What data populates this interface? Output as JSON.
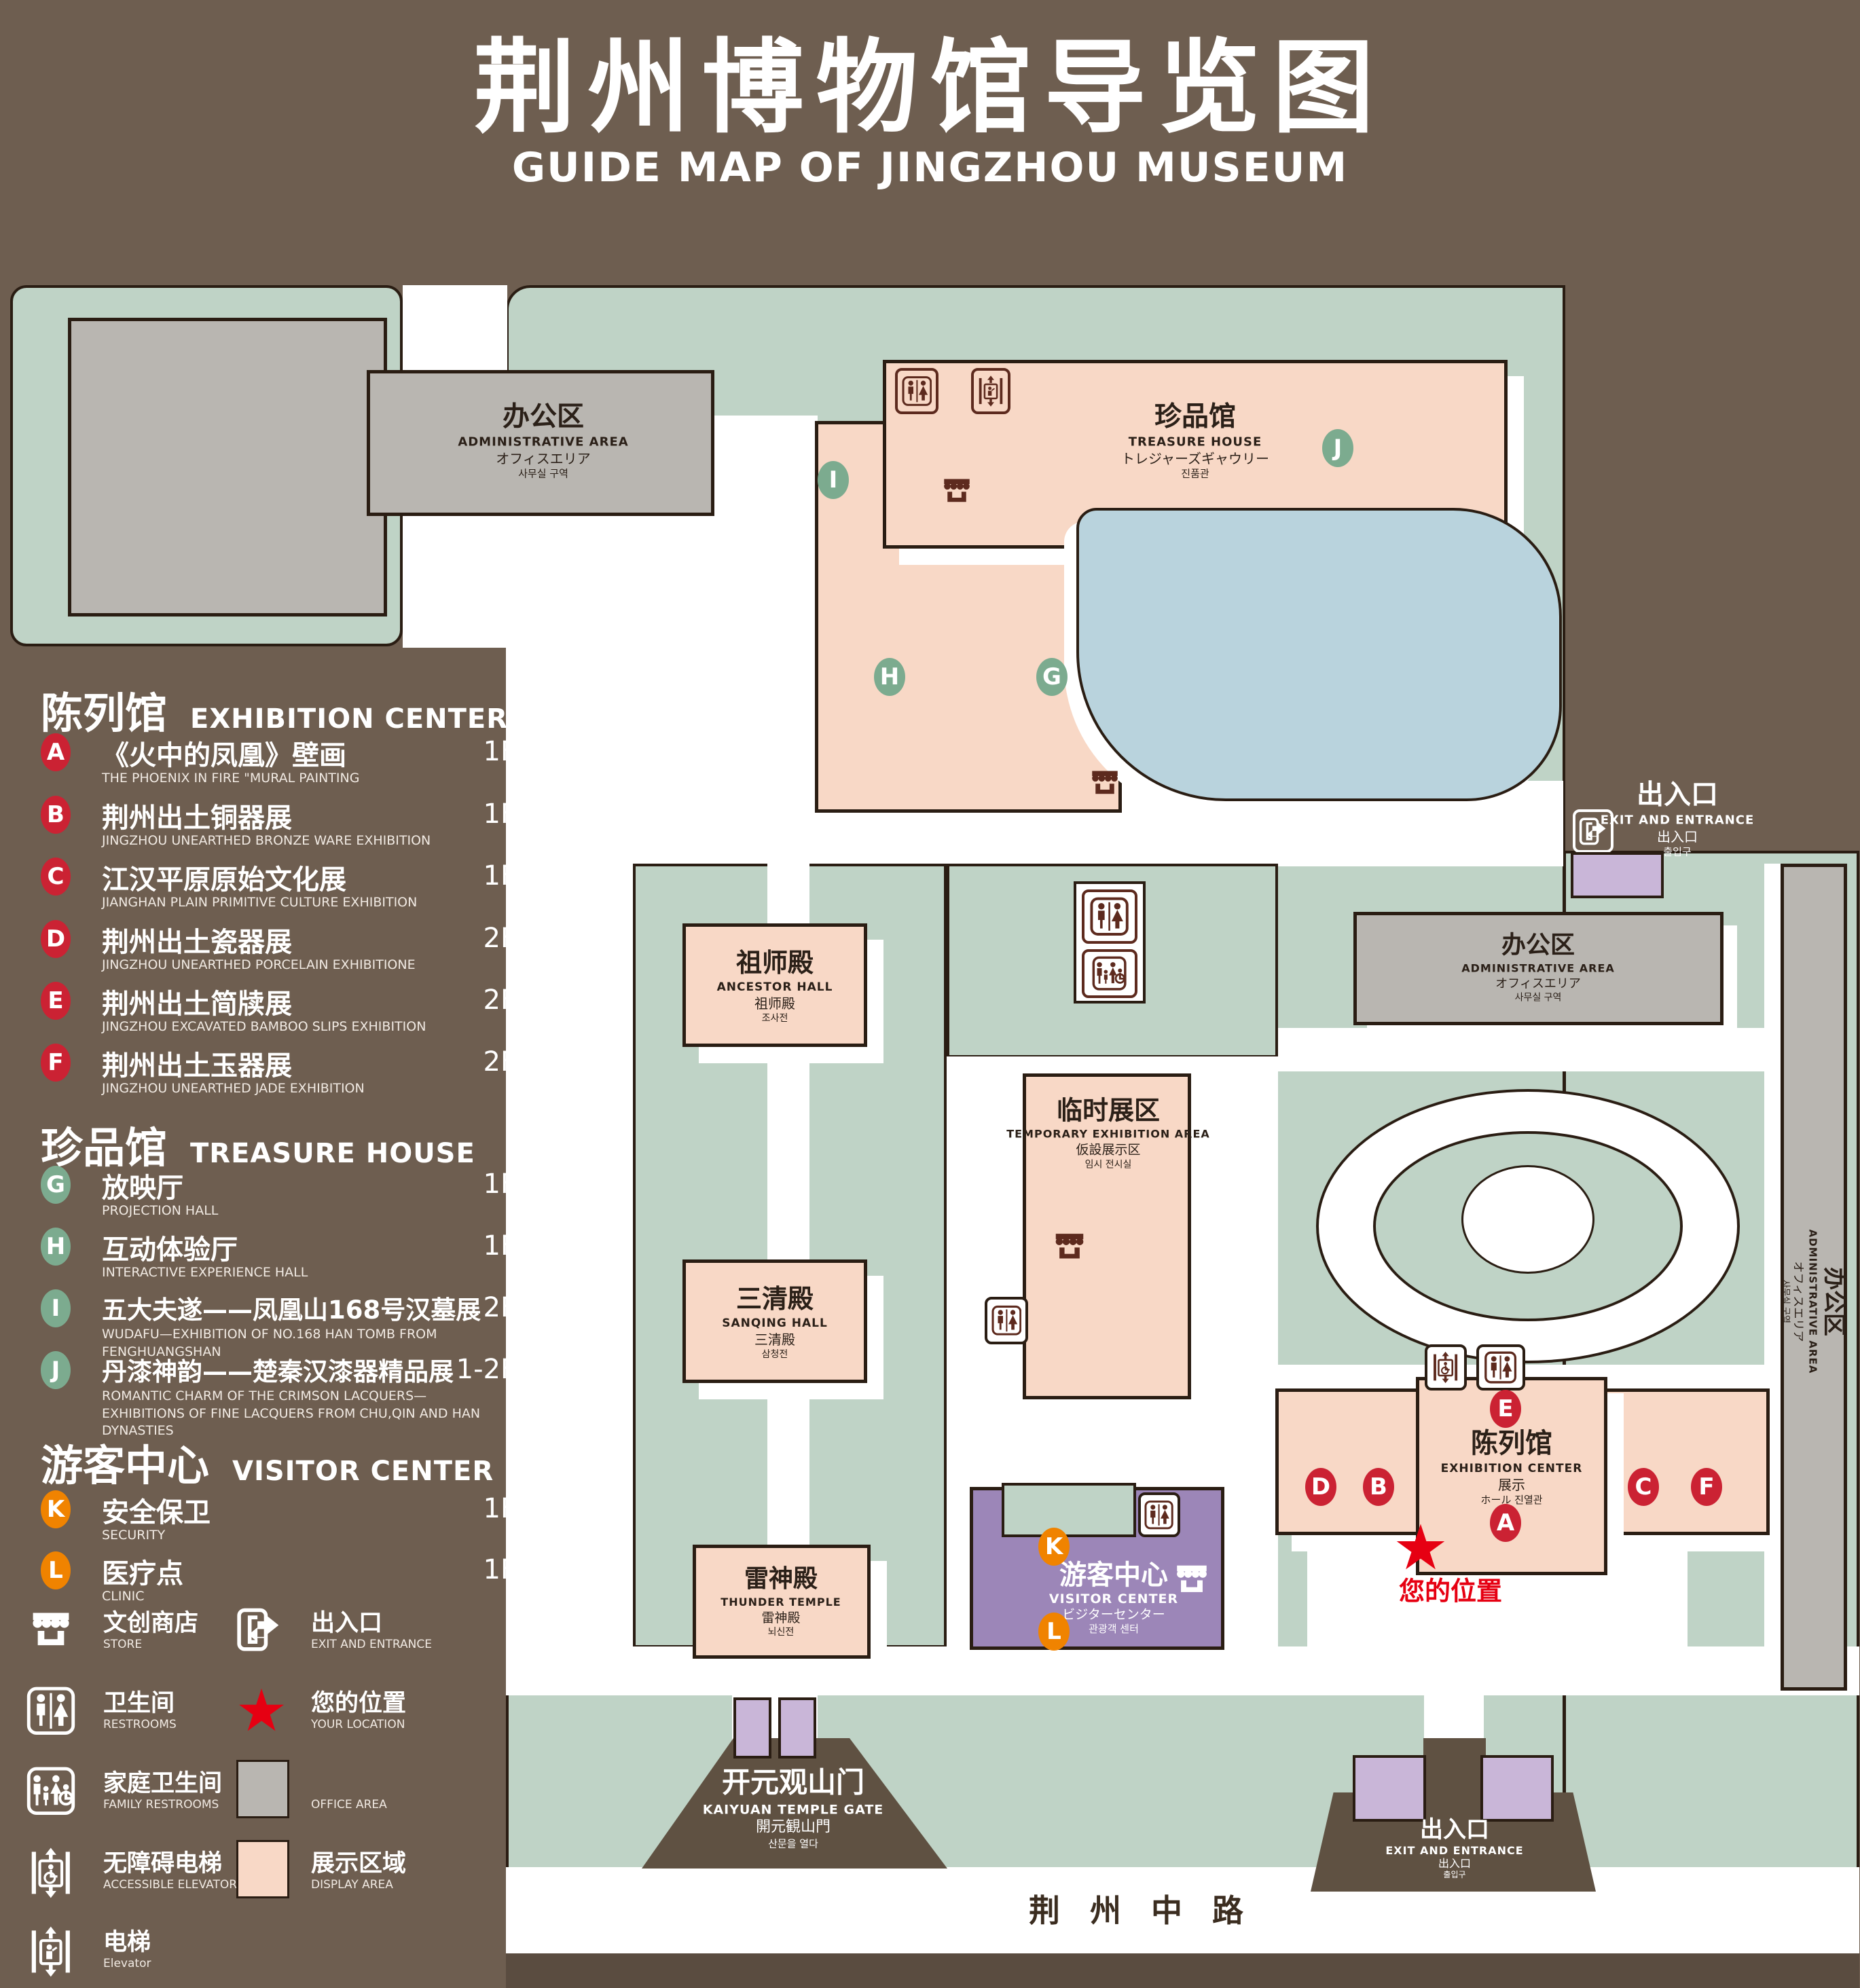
{
  "title": {
    "zh": "荆州博物馆导览图",
    "en": "GUIDE MAP OF JINGZHOU MUSEUM"
  },
  "legend": {
    "sections": [
      {
        "title_zh": "陈列馆",
        "title_en": "EXHIBITION CENTER",
        "items": [
          {
            "letter": "A",
            "zh": "《火中的凤凰》壁画",
            "en": "THE PHOENIX IN FIRE \"MURAL PAINTING",
            "floor": "1F"
          },
          {
            "letter": "B",
            "zh": "荆州出土铜器展",
            "en": "JINGZHOU UNEARTHED BRONZE WARE EXHIBITION",
            "floor": "1F"
          },
          {
            "letter": "C",
            "zh": "江汉平原原始文化展",
            "en": "JIANGHAN PLAIN PRIMITIVE CULTURE EXHIBITION",
            "floor": "1F"
          },
          {
            "letter": "D",
            "zh": "荆州出土瓷器展",
            "en": "JINGZHOU UNEARTHED PORCELAIN EXHIBITIONE",
            "floor": "2F"
          },
          {
            "letter": "E",
            "zh": "荆州出土简牍展",
            "en": "JINGZHOU EXCAVATED BAMBOO SLIPS EXHIBITION",
            "floor": "2F"
          },
          {
            "letter": "F",
            "zh": "荆州出土玉器展",
            "en": "JINGZHOU UNEARTHED JADE EXHIBITION",
            "floor": "2F"
          }
        ]
      },
      {
        "title_zh": "珍品馆",
        "title_en": "TREASURE HOUSE",
        "items": [
          {
            "letter": "G",
            "zh": "放映厅",
            "en": "PROJECTION HALL",
            "floor": "1F"
          },
          {
            "letter": "H",
            "zh": "互动体验厅",
            "en": "INTERACTIVE EXPERIENCE HALL",
            "floor": "1F"
          },
          {
            "letter": "I",
            "zh": "五大夫遂——凤凰山168号汉墓展",
            "en": "WUDAFU—EXHIBITION OF NO.168 HAN TOMB FROM FENGHUANGSHAN",
            "floor": "2F"
          },
          {
            "letter": "J",
            "zh": "丹漆神韵——楚秦汉漆器精品展",
            "en": "ROMANTIC CHARM OF THE CRIMSON LACQUERS—EXHIBITIONS OF FINE LACQUERS FROM CHU,QIN AND HAN DYNASTIES",
            "floor": "1-2F"
          }
        ]
      },
      {
        "title_zh": "游客中心",
        "title_en": "VISITOR CENTER",
        "items": [
          {
            "letter": "K",
            "zh": "安全保卫",
            "en": "SECURITY",
            "floor": "1F"
          },
          {
            "letter": "L",
            "zh": "医疗点",
            "en": "CLINIC",
            "floor": "1F"
          }
        ]
      }
    ],
    "symbols": [
      {
        "icon": "store-icon",
        "zh": "文创商店",
        "en": "STORE"
      },
      {
        "icon": "exit-icon",
        "zh": "出入口",
        "en": "EXIT AND ENTRANCE"
      },
      {
        "icon": "restrooms-icon",
        "zh": "卫生间",
        "en": "RESTROOMS"
      },
      {
        "icon": "your-location-icon",
        "zh": "您的位置",
        "en": "YOUR LOCATION"
      },
      {
        "icon": "family-restrooms-icon",
        "zh": "家庭卫生间",
        "en": "FAMILY RESTROOMS"
      },
      {
        "icon": "office-area-swatch",
        "zh": "办公区域",
        "en": "OFFICE AREA"
      },
      {
        "icon": "accessible-elevator-icon",
        "zh": "无障碍电梯",
        "en": "ACCESSIBLE ELEVATOR"
      },
      {
        "icon": "display-area-swatch",
        "zh": "展示区域",
        "en": "DISPLAY AREA"
      },
      {
        "icon": "elevator-icon",
        "zh": "电梯",
        "en": "Elevator"
      }
    ]
  },
  "map": {
    "buildings": {
      "admin_northwest": {
        "lines": [
          "办公区",
          "ADMINISTRATIVE AREA",
          "オフィスエリア",
          "사무실 구역"
        ]
      },
      "treasure_house": {
        "lines": [
          "珍品馆",
          "TREASURE HOUSE",
          "トレジャーズギャウリー",
          "진품관"
        ]
      },
      "ancestor_hall": {
        "lines": [
          "祖师殿",
          "ANCESTOR HALL",
          "祖师殿",
          "조사전"
        ]
      },
      "admin_east": {
        "lines": [
          "办公区",
          "ADMINISTRATIVE AREA",
          "オフィスエリア",
          "사무실 구역"
        ]
      },
      "temporary_exhibition": {
        "lines": [
          "临时展区",
          "TEMPORARY EXHIBITION AREA",
          "仮設展示区",
          "임시 전시실"
        ]
      },
      "sanqing_hall": {
        "lines": [
          "三清殿",
          "SANQING HALL",
          "三清殿",
          "삼청전"
        ]
      },
      "exhibition_center": {
        "lines": [
          "陈列馆",
          "EXHIBITION CENTER",
          "展示",
          "ホール 진열관"
        ]
      },
      "thunder_temple": {
        "lines": [
          "雷神殿",
          "THUNDER TEMPLE",
          "雷神殿",
          "뇌신전"
        ]
      },
      "visitor_center": {
        "lines": [
          "游客中心",
          "VISITOR CENTER",
          "ビジターセンター",
          "관광객 센터"
        ]
      },
      "admin_southeast": {
        "lines": [
          "办公区",
          "ADMINISTRATIVE AREA",
          "オフィスエリア",
          "사무실 구역"
        ]
      },
      "kaiyuan_gate": {
        "lines": [
          "开元观山门",
          "KAIYUAN TEMPLE GATE",
          "開元観山門",
          "산문을 열다"
        ]
      },
      "east_exit": {
        "lines": [
          "出入口",
          "EXIT AND ENTRANCE",
          "出入口",
          "출입구"
        ]
      },
      "south_exit": {
        "lines": [
          "出入口",
          "EXIT AND ENTRANCE",
          "出入口",
          "출입구"
        ]
      },
      "road": {
        "name": "荆 州 中 路"
      }
    },
    "markers": [
      {
        "letter": "A"
      },
      {
        "letter": "B"
      },
      {
        "letter": "C"
      },
      {
        "letter": "D"
      },
      {
        "letter": "E"
      },
      {
        "letter": "F"
      },
      {
        "letter": "G"
      },
      {
        "letter": "H"
      },
      {
        "letter": "I"
      },
      {
        "letter": "J"
      },
      {
        "letter": "K"
      },
      {
        "letter": "L"
      }
    ],
    "your_location": {
      "label": "您的位置",
      "star": "★"
    }
  },
  "colors": {
    "background": "#6e5e50",
    "landscape_green": "#bfd3c6",
    "display_area_pink": "#f8d8c6",
    "office_area_gray": "#b9b6b1",
    "water_blue": "#b9d3dd",
    "visitor_center_purple": "#9c86b8",
    "gate_lavender": "#c9b6d8",
    "marker_red": "#cb2233",
    "marker_green": "#7cab8f",
    "marker_orange": "#f08300",
    "location_red": "#e60012",
    "outline_dark": "#2a1d13"
  }
}
